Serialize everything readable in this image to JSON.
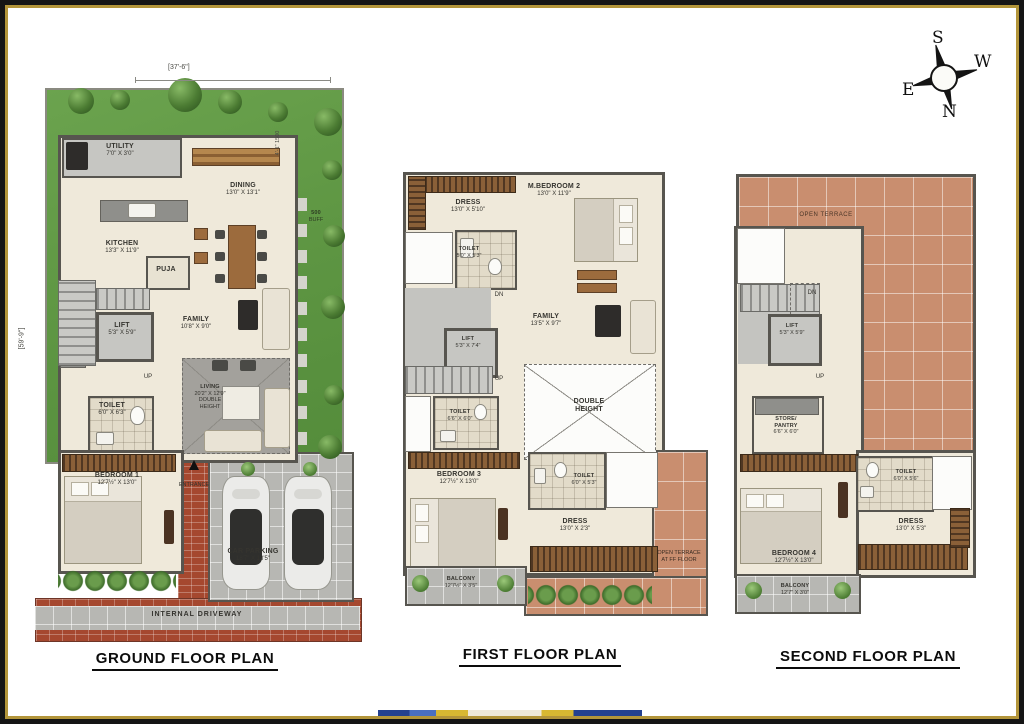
{
  "compass": {
    "top": "S",
    "right": "W",
    "left": "E",
    "bottom": "N"
  },
  "ground": {
    "title": "GROUND FLOOR PLAN",
    "dim_top": "[37'-6\"]",
    "dim_left": "[59'-9\"]",
    "side_note": "4'-1\" 1500",
    "buffer_line1": "500",
    "buffer_line2": "BUFF",
    "rooms": {
      "utility": {
        "name": "UTILITY",
        "dims": "7'0\" X 3'0\""
      },
      "kitchen": {
        "name": "KITCHEN",
        "dims": "13'3\" X 11'9\""
      },
      "dining": {
        "name": "DINING",
        "dims": "13'0\" X 13'1\""
      },
      "puja": {
        "name": "PUJA"
      },
      "family": {
        "name": "FAMILY",
        "dims": "10'8\" X 9'0\""
      },
      "lift": {
        "name": "LIFT",
        "dims": "5'3\" X 5'9\""
      },
      "stairs_up": {
        "name": "UP"
      },
      "toilet": {
        "name": "TOILET",
        "dims": "6'0\" X 6'3\""
      },
      "living": {
        "name": "LIVING",
        "dims": "20'2\" X 12'9\"",
        "note1": "DOUBLE",
        "note2": "HEIGHT"
      },
      "bedroom1": {
        "name": "BEDROOM 1",
        "dims": "12'7½\" X 13'0\""
      },
      "entrance": {
        "name": "ENTRANCE"
      },
      "car_parking": {
        "name": "CAR PARKING",
        "dims": "18'7\" X 18'5\""
      },
      "driveway": {
        "name": "INTERNAL DRIVEWAY"
      }
    }
  },
  "first": {
    "title": "FIRST FLOOR PLAN",
    "rooms": {
      "dress": {
        "name": "DRESS",
        "dims": "13'0\" X 5'10\""
      },
      "master_bedroom2": {
        "name": "M.BEDROOM 2",
        "dims": "13'0\" X 11'9\""
      },
      "toilet_top": {
        "name": "TOILET",
        "dims": "5'0\" X 5'3\""
      },
      "dn": {
        "name": "DN"
      },
      "family": {
        "name": "FAMILY",
        "dims": "13'5\" X 9'7\""
      },
      "lift": {
        "name": "LIFT",
        "dims": "5'3\" X 7'4\""
      },
      "up": {
        "name": "UP"
      },
      "toilet_mid": {
        "name": "TOILET",
        "dims": "6'6\" X 6'0\""
      },
      "double_height": {
        "line1": "DOUBLE",
        "line2": "HEIGHT"
      },
      "bedroom3": {
        "name": "BEDROOM 3",
        "dims": "12'7½\" X 13'0\""
      },
      "toilet_low": {
        "name": "TOILET",
        "dims": "6'0\" X 5'3\""
      },
      "dress_low": {
        "name": "DRESS",
        "dims": "13'0\" X 2'3\""
      },
      "balcony": {
        "name": "BALCONY",
        "dims": "12'7½\" X 3'5\""
      },
      "terrace_note": {
        "line1": "OPEN TERRACE",
        "line2": "AT FF FLOOR"
      }
    }
  },
  "second": {
    "title": "SECOND FLOOR PLAN",
    "rooms": {
      "open_terrace": {
        "name": "OPEN TERRACE"
      },
      "dn": {
        "name": "DN"
      },
      "lift": {
        "name": "LIFT",
        "dims": "5'3\" X 5'9\""
      },
      "up": {
        "name": "UP"
      },
      "store": {
        "line1": "STORE/",
        "line2": "PANTRY",
        "dims": "6'6\" X 6'0\""
      },
      "toilet": {
        "name": "TOILET",
        "dims": "6'0\" X 5'6\""
      },
      "dress": {
        "name": "DRESS",
        "dims": "13'0\" X 5'3\""
      },
      "bedroom4": {
        "name": "BEDROOM 4",
        "dims": "12'7½\" X 13'0\""
      },
      "balcony": {
        "name": "BALCONY",
        "dims": "12'7\" X 3'0\""
      }
    }
  }
}
